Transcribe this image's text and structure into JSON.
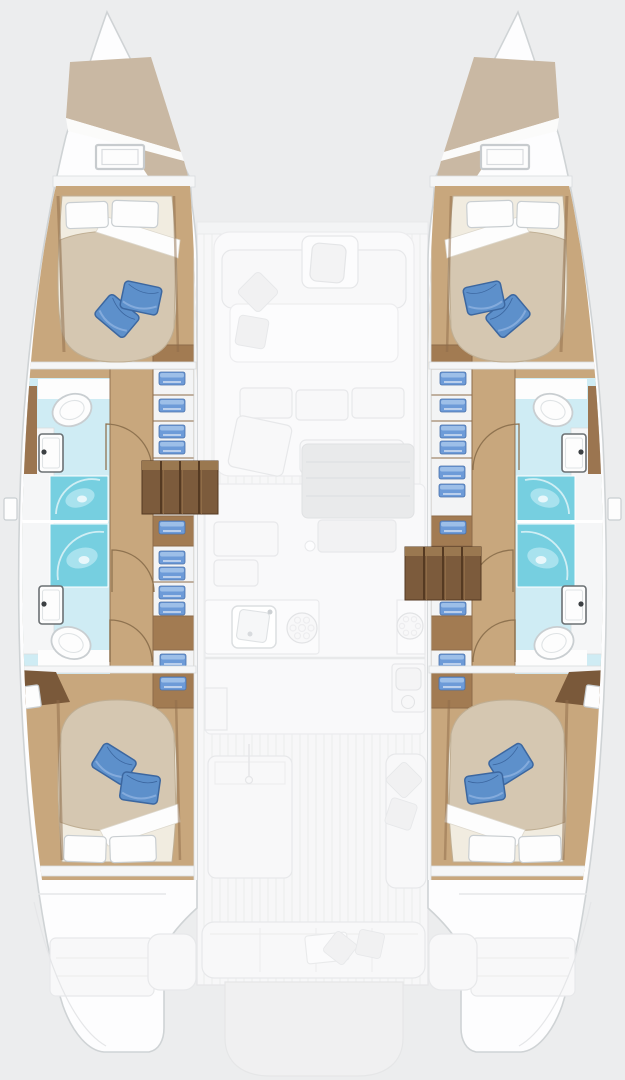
{
  "meta": {
    "title": "Catamaran 4-cabin layout floor plan (top view, bows up)"
  },
  "boat": {
    "type": "catamaran",
    "view": "top-down, bows up, symmetric twin hulls",
    "cabin_count": 4,
    "bathroom_count": 4,
    "shower_count": 4,
    "port_hull": {
      "rooms": [
        "bow-locker-with-hatch",
        "forward-cabin",
        "forward-bathroom",
        "wardrobe-lockers",
        "companionway-steps",
        "aft-bathroom",
        "aft-cabin",
        "transom-swim-platform"
      ],
      "steps_position": "upper-mid hull"
    },
    "starboard_hull": {
      "rooms": [
        "bow-locker-with-hatch",
        "forward-cabin",
        "forward-bathroom",
        "wardrobe-lockers",
        "companionway-steps",
        "aft-bathroom",
        "aft-cabin",
        "transom-swim-platform"
      ],
      "steps_position": "lower-mid hull"
    },
    "center_deck": {
      "zones": [
        "crossbeam",
        "mast-step-table",
        "foredeck-lounge",
        "salon-settee",
        "coffee-table",
        "galley-sink",
        "stove-burners",
        "fridge",
        "cockpit-table",
        "cockpit-sofa",
        "aft-bench",
        "tender-platform"
      ]
    },
    "furniture": {
      "forward_cabin": "double berth, two white pillows, two blue cushions",
      "aft_cabin": "double berth, two white pillows, two blue cushions",
      "forward_bathroom": "toilet, washbasin, shower stall",
      "aft_bathroom": "toilet, washbasin, shower stall",
      "lockers": "shelved cabinets with folded blue towels"
    }
  },
  "icons": {
    "toilet": "white oval bowl",
    "sink": "rectangular basin with tap dot",
    "shower": "cyan square with swirl highlight",
    "stove": "circle with burner ring",
    "towel": "folded blue stack",
    "hatch": "white framed rectangle"
  },
  "colors": {
    "background": "#ecedee",
    "hull_fill": "#fdfdfe",
    "hull_stroke": "#cfd3d5",
    "deck_fill": "#f7f7f8",
    "deck_plank": "#ebeced",
    "deck_stroke": "#e5e6e8",
    "faded_fill": "#f8f8f9",
    "faded_stroke": "#e7e8ea",
    "faded_line": "#ededef",
    "faded_dark": "#e9eaeb",
    "faded_dark_stroke": "#e0e1e3",
    "faded_pillow": "#f1f1f2",
    "wood_floor": "#c8a77d",
    "wood_dark": "#9b7550",
    "wood_trim": "#8d6b49",
    "cell_white": "#f3f4f5",
    "cell_brown": "#a27b52",
    "steps_fill": "#7c5b3c",
    "steps_line": "#553a22",
    "steps_top": "#9a7850",
    "steps_hi": "#8f6c47",
    "bow_shade": "#c9b8a3",
    "bath_floor": "#cfecf4",
    "shower_fill": "#76cfe0",
    "shower_light": "#a8e2ee",
    "bed_sheet": "#f1ece0",
    "bed_duvet": "#d5c7b1",
    "bed_edge": "#bfae93",
    "pillow_blue": "#5d90cb",
    "pillow_blue_dark": "#3c67a0",
    "pillow_blue_light": "#84abdc",
    "towel_blue": "#6d9bd8",
    "towel_light": "#9dbfe8",
    "towel_dark": "#4a72ab",
    "towel_line": "#e8eef7",
    "white": "#fdfdfd",
    "wall_fill": "#f5f6f7",
    "wall_stroke": "#d9dcde",
    "outline_gray": "#c9ced1",
    "fixture_stroke": "#6b7073",
    "fixture_inner": "#dfe3e5",
    "door_stroke": "#8f7350",
    "headboard_brown": "#7a593a"
  }
}
